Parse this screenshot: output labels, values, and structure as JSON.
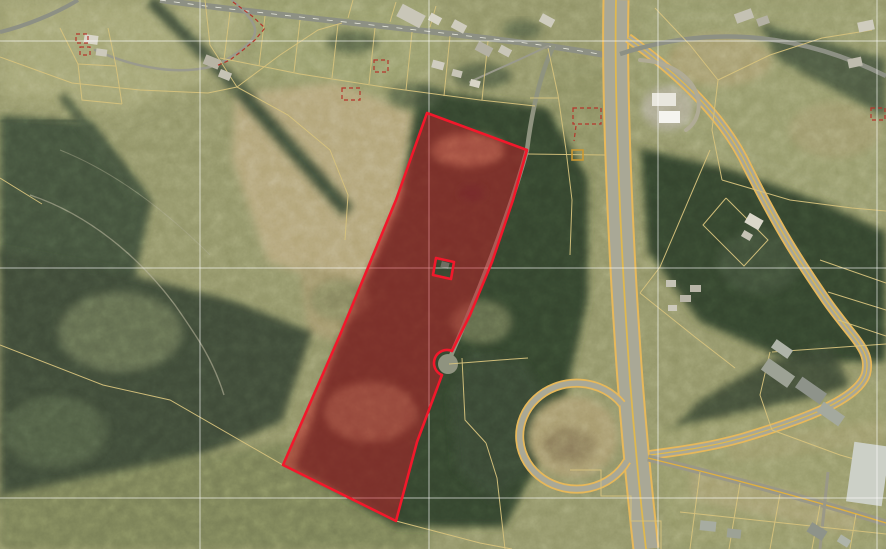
{
  "map": {
    "type": "satellite-parcel-viewer",
    "canvas": {
      "width": 886,
      "height": 549
    },
    "colors": {
      "highlight_stroke": "#f2182b",
      "highlight_fill": "rgba(208,24,38,0.46)",
      "parcel_line": "#d6c27c",
      "grid_line": "rgba(255,255,255,0.62)",
      "annotation_red": "#b5352b",
      "road_minor": "#8d9084",
      "road_edge_yellow": "#e7b85a",
      "highway_pavement": "#a9a896",
      "road_center_yellow": "#dfb84e",
      "marker_yellow": "#cc9933",
      "culdesac_pavement": "#8f937f"
    },
    "grid": {
      "vertical_x": [
        200,
        429,
        658,
        877
      ],
      "horizontal_y": [
        41,
        268,
        498
      ]
    },
    "highlight_parcel": {
      "name": "selected-parcel",
      "path": "M427,113 L527,150 L513,200 L492,262 L470,315 L452,351 A13,13 0 1 0 442,375 L417,442 L396,521 L283,465 L340,335 L396,200 Z M436,258 L454,262 L451,279 L433,275 Z",
      "stroke_width": 2.6
    },
    "culdesac": {
      "cx": 448,
      "cy": 364,
      "r": 10
    },
    "roads": [
      {
        "name": "rural-road-top",
        "d": "M160,0 C260,14 430,30 548,46 C575,50 600,54 616,57",
        "layers": [
          [
            "#8d9084",
            6
          ]
        ],
        "center": [
          "#e8e8dc",
          0.8,
          "6 8"
        ]
      },
      {
        "name": "lane-topleft",
        "d": "M232,0 C252,18 262,30 250,42 C240,52 225,62 210,67 C180,74 140,70 95,50",
        "layers": [
          [
            "#9a9a8c",
            2.5
          ]
        ],
        "cap": "round"
      },
      {
        "name": "road-topleft-corner",
        "d": "M78,0 C55,14 25,26 0,32",
        "layers": [
          [
            "#8d9084",
            4
          ]
        ]
      },
      {
        "name": "driveway-topcenter",
        "d": "M548,46 C520,60 490,72 470,82",
        "layers": [
          [
            "#9a9a8c",
            2
          ]
        ],
        "cap": "round"
      },
      {
        "name": "culdesac-road",
        "d": "M553,47 C540,75 532,110 527,150 C512,205 485,275 466,320 C459,338 452,352 449,361",
        "layers": [
          [
            "#8f937f",
            4.5
          ]
        ],
        "cap": "round"
      },
      {
        "name": "highway-vertical",
        "d": "M616,0 C614,90 620,240 630,380 C635,445 641,505 646,549",
        "layers": [
          [
            "#e7b85a",
            27
          ],
          [
            "#a9a896",
            23
          ]
        ],
        "center": [
          "#dfb84e",
          1.8
        ]
      },
      {
        "name": "route-east-curve",
        "d": "M628,38 C676,72 724,116 748,168 C780,232 800,262 826,300 C854,340 872,350 866,374 C858,400 802,420 742,438 C706,448 672,452 650,455",
        "layers": [
          [
            "#e7b85a",
            10
          ],
          [
            "#a9a896",
            6.5
          ]
        ],
        "center": [
          "#dfb84e",
          1.2
        ]
      },
      {
        "name": "road-southeast",
        "d": "M648,458 C730,478 812,500 886,523",
        "layers": [
          [
            "#9a9887",
            7
          ]
        ],
        "center": [
          "#dfb040",
          1.4
        ]
      },
      {
        "name": "road-northeast",
        "d": "M620,54 C700,28 790,28 886,76",
        "layers": [
          [
            "#8d9084",
            4.5
          ]
        ]
      },
      {
        "name": "loop-ramp",
        "d": "M622,404 A57,53 0 1 0 627,461",
        "layers": [
          [
            "#e7b85a",
            9
          ],
          [
            "#a9a896",
            5.5
          ]
        ]
      },
      {
        "name": "gas-station-loop",
        "d": "M640,60 C668,62 688,74 696,92 C702,106 698,122 686,130",
        "layers": [
          [
            "#b0ab95",
            4
          ]
        ],
        "cap": "round"
      },
      {
        "name": "driveway-bottomright",
        "d": "M828,472 L820,549",
        "layers": [
          [
            "#9a9887",
            3
          ]
        ]
      }
    ],
    "parcel_lines": [
      "0,57 72,83 140,90 208,93 237,87",
      "237,87 210,45 205,0",
      "237,87 280,55 318,30 342,23",
      "237,87 288,115 330,150 348,195 345,240",
      "60,28 78,64 82,100 122,104",
      "108,28 116,66 122,104",
      "78,64 116,66",
      "230,12 224,60",
      "265,16 259,66",
      "300,20 294,72",
      "338,24 332,78",
      "375,28 369,84",
      "412,32 406,90",
      "450,36 444,96",
      "488,41 482,100",
      "220,58 300,74 390,88 480,100 535,106",
      "348,18 353,0",
      "390,22 396,2",
      "430,27 436,6",
      "548,48 558,95 566,150 572,200 570,255",
      "530,98 558,98",
      "528,154 605,155",
      "655,8 690,45 718,80",
      "718,80 770,55 822,38 872,30",
      "718,80 712,130 722,180",
      "722,180 790,200 852,208 886,211",
      "0,345 103,385 170,400 283,465 396,521 480,543 512,549",
      "486,443 497,478 505,549",
      "449,364 500,360 528,358",
      "462,358 465,420 486,443",
      "570,470 601,470 601,496 631,496 631,521 661,521 661,549",
      "772,352 886,344",
      "770,352 760,395 772,430",
      "772,430 840,455 886,468",
      "640,293 695,337 735,368",
      "710,150 660,267 640,293",
      "726,198 768,240 744,266 703,225 726,198",
      "820,260 886,283",
      "828,292 886,310",
      "838,320 886,336",
      "700,472 690,549",
      "740,483 729,549",
      "780,494 770,549",
      "820,505 812,549",
      "856,514 850,549",
      "680,512 886,534",
      "0,178 42,204"
    ],
    "marker_squares": [
      {
        "x": 572,
        "y": 150,
        "w": 11,
        "h": 10
      }
    ],
    "buildings": [
      [
        84,
        35,
        14,
        9,
        8,
        "#d9d6c9"
      ],
      [
        96,
        49,
        11,
        7,
        8,
        "#ccc9bb"
      ],
      [
        204,
        57,
        16,
        10,
        22,
        "#b8b4a5"
      ],
      [
        219,
        71,
        12,
        8,
        22,
        "#c6c3b5"
      ],
      [
        398,
        9,
        26,
        14,
        28,
        "#c9c6b8"
      ],
      [
        429,
        15,
        12,
        8,
        28,
        "#d8d5c8"
      ],
      [
        452,
        22,
        14,
        9,
        28,
        "#cfccbe"
      ],
      [
        476,
        44,
        16,
        10,
        28,
        "#b4b1a3"
      ],
      [
        499,
        47,
        12,
        8,
        28,
        "#c9c6b8"
      ],
      [
        540,
        16,
        14,
        9,
        28,
        "#cfccbe"
      ],
      [
        432,
        61,
        12,
        8,
        15,
        "#d0cdc0"
      ],
      [
        452,
        70,
        10,
        7,
        15,
        "#c8c5b7"
      ],
      [
        470,
        80,
        10,
        7,
        15,
        "#d8d5c8"
      ],
      [
        652,
        93,
        24,
        13,
        0,
        "#e9e7de"
      ],
      [
        659,
        111,
        21,
        12,
        0,
        "#f5f4ef"
      ],
      [
        735,
        11,
        18,
        10,
        -20,
        "#c4c1b3"
      ],
      [
        757,
        17,
        12,
        8,
        -20,
        "#b4b1a3"
      ],
      [
        858,
        21,
        16,
        10,
        -12,
        "#cfccbe"
      ],
      [
        848,
        58,
        14,
        9,
        -12,
        "#bfbcae"
      ],
      [
        666,
        280,
        10,
        7,
        0,
        "#c6c3b5"
      ],
      [
        680,
        295,
        11,
        7,
        0,
        "#b8b5a7"
      ],
      [
        668,
        305,
        9,
        6,
        0,
        "#ccc9bb"
      ],
      [
        746,
        216,
        16,
        11,
        30,
        "#dad7ca"
      ],
      [
        742,
        232,
        10,
        7,
        30,
        "#c6c3b5"
      ],
      [
        690,
        285,
        11,
        7,
        0,
        "#b8b5a7"
      ],
      [
        762,
        366,
        32,
        14,
        35,
        "#9da295"
      ],
      [
        796,
        384,
        30,
        13,
        35,
        "#8e938a"
      ],
      [
        818,
        408,
        26,
        12,
        35,
        "#a4a99e"
      ],
      [
        772,
        344,
        20,
        10,
        35,
        "#afb4a9"
      ],
      [
        850,
        444,
        36,
        60,
        8,
        "#ccd0c7"
      ],
      [
        700,
        521,
        16,
        10,
        6,
        "#a7aca1"
      ],
      [
        727,
        529,
        14,
        9,
        6,
        "#9da295"
      ],
      [
        808,
        526,
        18,
        11,
        32,
        "#8e938a"
      ],
      [
        838,
        537,
        12,
        8,
        32,
        "#afb4a9"
      ],
      [
        441,
        262,
        8,
        6,
        15,
        "#6e6e62"
      ]
    ],
    "annotations": [
      {
        "type": "path",
        "d": "M233,2 L252,16 L265,28 L255,40 L243,50 L230,60 L216,66"
      },
      {
        "type": "rect",
        "x": 76,
        "y": 34,
        "w": 12,
        "h": 9
      },
      {
        "type": "rect",
        "x": 80,
        "y": 47,
        "w": 10,
        "h": 8
      },
      {
        "type": "rect",
        "x": 342,
        "y": 88,
        "w": 18,
        "h": 12
      },
      {
        "type": "rect",
        "x": 374,
        "y": 60,
        "w": 14,
        "h": 12
      },
      {
        "type": "rect",
        "x": 573,
        "y": 108,
        "w": 28,
        "h": 16
      },
      {
        "type": "path",
        "d": "M576,126 L574,141"
      },
      {
        "type": "rect",
        "x": 871,
        "y": 108,
        "w": 14,
        "h": 12
      }
    ]
  }
}
